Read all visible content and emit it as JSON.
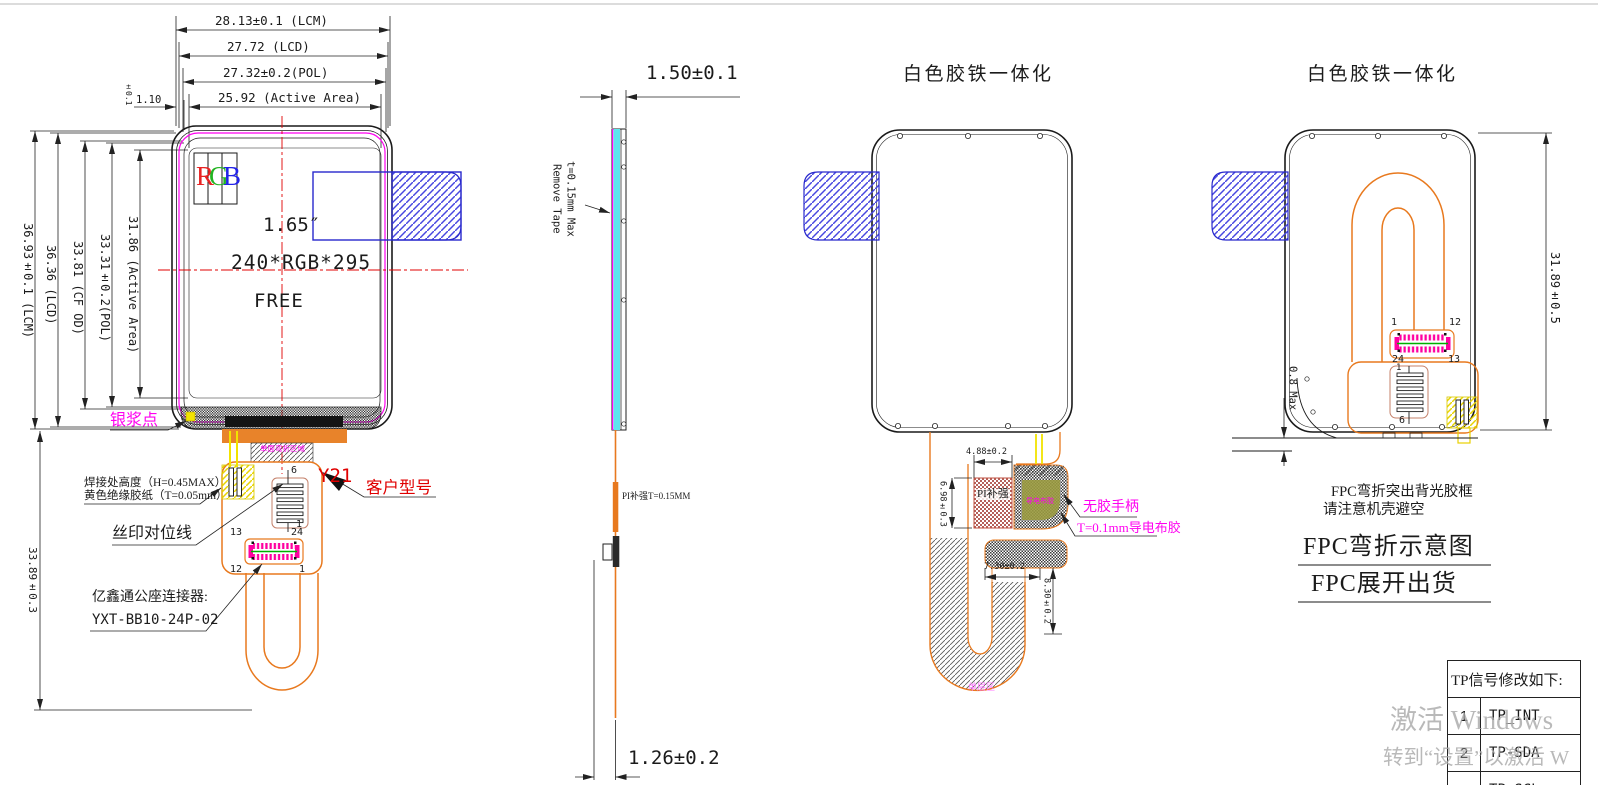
{
  "view1": {
    "dims_top": [
      "28.13±0.1 (LCM)",
      "27.72 (LCD)",
      "27.32±0.2(POL)",
      "25.92 (Active Area)"
    ],
    "dim_gap": "1.10",
    "dim_gap_tol": "±0.1",
    "dims_left": [
      "36.93±0.1 (LCM)",
      "36.36 (LCD)",
      "33.81 (CF OD)",
      "33.31±0.2(POL)",
      "31.86 (Active Area)"
    ],
    "dim_fpc_length": "33.89±0.3",
    "rgb": {
      "r": "R",
      "g": "G",
      "b": "B"
    },
    "size_inch": "1.65″",
    "resolution": "240*RGB*295",
    "free": "FREE",
    "silver_dot": "银浆点",
    "bend_zone": "单面弯折区域",
    "solder_line1": "焊接处高度（H=0.45MAX）",
    "solder_line2": "黄色绝缘胶纸（T=0.05mm）",
    "silk_align": "丝印对位线",
    "model": "Y21",
    "customer_model": "客户型号",
    "connector_line1": "亿鑫通公座连接器:",
    "connector_line2": "YXT-BB10-24P-02",
    "pins": {
      "p6": "6",
      "p1t": "1",
      "p13": "13",
      "p24": "24",
      "p12": "12",
      "p1b": "1"
    }
  },
  "view2": {
    "dim_width": "1.50±0.1",
    "remove_tape_l1": "Remove Tape",
    "remove_tape_l2": "t=0.15mm Max",
    "pi_note": "PI补强T=0.15MM",
    "dim_bottom": "1.26±0.2"
  },
  "view3": {
    "title": "白色胶铁一体化",
    "pi_label": "PI补强",
    "dim_w": "4.88±0.2",
    "dim_h": "6.98±0.3",
    "dim_w2": "7.30±0.2",
    "dim_h2": "8.30±0.2",
    "no_glue": "无胶手柄",
    "tape": "T=0.1mm导电布胶",
    "tape_small": "导电布胶",
    "single_layer": "单层区"
  },
  "view4": {
    "title": "白色胶铁一体化",
    "dim_height": "31.89±0.5",
    "dim_fold": "0.8 Max",
    "note1": "FPC弯折突出背光胶框",
    "note2": "请注意机壳避空",
    "caption1": "FPC弯折示意图",
    "caption2": "FPC展开出货",
    "pins": {
      "p1": "1",
      "p12": "12",
      "p24": "24",
      "p13": "13",
      "pz1": "1",
      "pz6": "6"
    }
  },
  "table": {
    "header": "TP信号修改如下:",
    "rows": [
      {
        "no": "1",
        "signal": "TP_INT"
      },
      {
        "no": "2",
        "signal": "TP-SDA"
      },
      {
        "no": "3",
        "signal": "TP-SCL"
      }
    ]
  },
  "watermark": {
    "line1": "激活 Windows",
    "line2": "转到“设置”以激活 W"
  },
  "colors": {
    "annotation_magenta": "#ff00f0",
    "customer_red": "#e00000",
    "fpc_orange": "#e8791e",
    "shield_blue": "#2828cc",
    "tape_cyan": "#5ce6ee",
    "insulation_yellow": "#f2e300"
  }
}
